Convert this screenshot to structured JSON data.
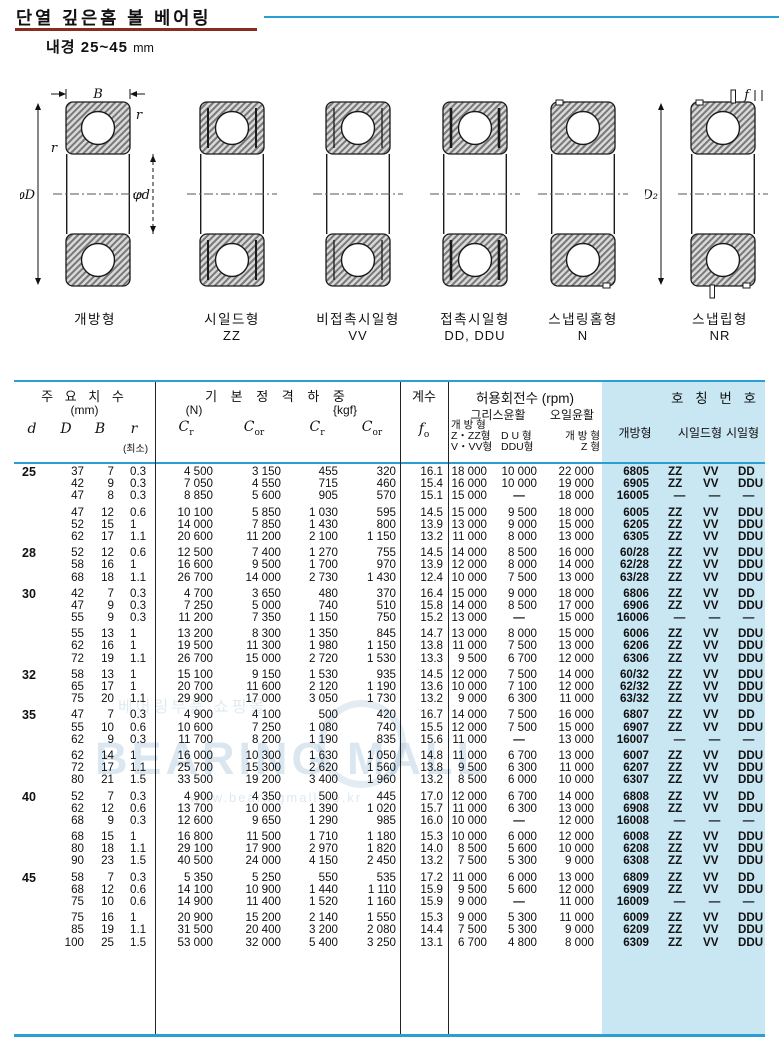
{
  "title": "단열 깊은홈 볼 베어링",
  "subtitle_label": "내경",
  "subtitle_range": "25~45",
  "subtitle_unit": "mm",
  "colors": {
    "accent_blue": "#2a9fd3",
    "light_blue": "#c9e6f3",
    "underline_red": "#8b2a1e"
  },
  "figures": [
    {
      "label": "개방형",
      "sublabel": ""
    },
    {
      "label": "시일드형",
      "sublabel": "ZZ"
    },
    {
      "label": "비접촉시일형",
      "sublabel": "VV"
    },
    {
      "label": "접촉시일형",
      "sublabel": "DD, DDU"
    },
    {
      "label": "스냅링홈형",
      "sublabel": "N"
    },
    {
      "label": "스냅립형",
      "sublabel": "NR"
    }
  ],
  "annotations": {
    "B": "B",
    "r": "r",
    "phiD": "φD",
    "phid": "φd",
    "f": "f",
    "phiD2": "φD₂"
  },
  "watermark": {
    "line1": "베어링부품 쇼핑몰",
    "line2": "BEARING MALL",
    "line3": "www.bearingmall.co.kr"
  },
  "table": {
    "header": {
      "dims_title": "주 요 치 수",
      "dims_unit": "(mm)",
      "col_d": "d",
      "col_D": "D",
      "col_B": "B",
      "col_r": "r",
      "r_min": "(최소)",
      "load_title": "기 본 정 격 하 중",
      "unit_n": "(N)",
      "unit_kgf": "{kgf}",
      "c_base": "C",
      "sub_r": "r",
      "sub_or": "or",
      "factor_title": "계수",
      "f_base": "f",
      "f_sub": "o",
      "rpm_title": "허용회전수 (rpm)",
      "grease_title": "그리스윤활",
      "oil_title": "오일윤활",
      "g1_l1": "개 방 형",
      "g1_l2": "Z・ZZ형",
      "g1_l3": "V・VV형",
      "g2_l2": "D U 형",
      "g2_l3": "DDU형",
      "oil_l2": "개 방 형",
      "oil_l3": "Z 형",
      "no_title": "호 칭 번 호",
      "no_open": "개방형",
      "no_shield": "시일드형",
      "no_seal": "시일형"
    },
    "groups": [
      {
        "d": "25",
        "blocks": [
          [
            [
              "37",
              "7",
              "0.3",
              "4 500",
              "3 150",
              "455",
              "320",
              "16.1",
              "18 000",
              "10 000",
              "22 000",
              "6805",
              "ZZ",
              "VV",
              "DD"
            ],
            [
              "42",
              "9",
              "0.3",
              "7 050",
              "4 550",
              "715",
              "460",
              "15.4",
              "16 000",
              "10 000",
              "19 000",
              "6905",
              "ZZ",
              "VV",
              "DDU"
            ],
            [
              "47",
              "8",
              "0.3",
              "8 850",
              "5 600",
              "905",
              "570",
              "15.1",
              "15 000",
              "—",
              "18 000",
              "16005",
              "—",
              "—",
              "—"
            ]
          ],
          [
            [
              "47",
              "12",
              "0.6",
              "10 100",
              "5 850",
              "1 030",
              "595",
              "14.5",
              "15 000",
              "9 500",
              "18 000",
              "6005",
              "ZZ",
              "VV",
              "DDU"
            ],
            [
              "52",
              "15",
              "1",
              "14 000",
              "7 850",
              "1 430",
              "800",
              "13.9",
              "13 000",
              "9 000",
              "15 000",
              "6205",
              "ZZ",
              "VV",
              "DDU"
            ],
            [
              "62",
              "17",
              "1.1",
              "20 600",
              "11 200",
              "2 100",
              "1 150",
              "13.2",
              "11 000",
              "8 000",
              "13 000",
              "6305",
              "ZZ",
              "VV",
              "DDU"
            ]
          ]
        ]
      },
      {
        "d": "28",
        "blocks": [
          [
            [
              "52",
              "12",
              "0.6",
              "12 500",
              "7 400",
              "1 270",
              "755",
              "14.5",
              "14 000",
              "8 500",
              "16 000",
              "60/28",
              "ZZ",
              "VV",
              "DDU"
            ],
            [
              "58",
              "16",
              "1",
              "16 600",
              "9 500",
              "1 700",
              "970",
              "13.9",
              "12 000",
              "8 000",
              "14 000",
              "62/28",
              "ZZ",
              "VV",
              "DDU"
            ],
            [
              "68",
              "18",
              "1.1",
              "26 700",
              "14 000",
              "2 730",
              "1 430",
              "12.4",
              "10 000",
              "7 500",
              "13 000",
              "63/28",
              "ZZ",
              "VV",
              "DDU"
            ]
          ]
        ]
      },
      {
        "d": "30",
        "blocks": [
          [
            [
              "42",
              "7",
              "0.3",
              "4 700",
              "3 650",
              "480",
              "370",
              "16.4",
              "15 000",
              "9 000",
              "18 000",
              "6806",
              "ZZ",
              "VV",
              "DD"
            ],
            [
              "47",
              "9",
              "0.3",
              "7 250",
              "5 000",
              "740",
              "510",
              "15.8",
              "14 000",
              "8 500",
              "17 000",
              "6906",
              "ZZ",
              "VV",
              "DDU"
            ],
            [
              "55",
              "9",
              "0.3",
              "11 200",
              "7 350",
              "1 150",
              "750",
              "15.2",
              "13 000",
              "—",
              "15 000",
              "16006",
              "—",
              "—",
              "—"
            ]
          ],
          [
            [
              "55",
              "13",
              "1",
              "13 200",
              "8 300",
              "1 350",
              "845",
              "14.7",
              "13 000",
              "8 000",
              "15 000",
              "6006",
              "ZZ",
              "VV",
              "DDU"
            ],
            [
              "62",
              "16",
              "1",
              "19 500",
              "11 300",
              "1 980",
              "1 150",
              "13.8",
              "11 000",
              "7 500",
              "13 000",
              "6206",
              "ZZ",
              "VV",
              "DDU"
            ],
            [
              "72",
              "19",
              "1.1",
              "26 700",
              "15 000",
              "2 720",
              "1 530",
              "13.3",
              "9 500",
              "6 700",
              "12 000",
              "6306",
              "ZZ",
              "VV",
              "DDU"
            ]
          ]
        ]
      },
      {
        "d": "32",
        "blocks": [
          [
            [
              "58",
              "13",
              "1",
              "15 100",
              "9 150",
              "1 530",
              "935",
              "14.5",
              "12 000",
              "7 500",
              "14 000",
              "60/32",
              "ZZ",
              "VV",
              "DDU"
            ],
            [
              "65",
              "17",
              "1",
              "20 700",
              "11 600",
              "2 120",
              "1 190",
              "13.6",
              "10 000",
              "7 100",
              "12 000",
              "62/32",
              "ZZ",
              "VV",
              "DDU"
            ],
            [
              "75",
              "20",
              "1.1",
              "29 900",
              "17 000",
              "3 050",
              "1 730",
              "13.2",
              "9 000",
              "6 300",
              "11 000",
              "63/32",
              "ZZ",
              "VV",
              "DDU"
            ]
          ]
        ]
      },
      {
        "d": "35",
        "blocks": [
          [
            [
              "47",
              "7",
              "0.3",
              "4 900",
              "4 100",
              "500",
              "420",
              "16.7",
              "14 000",
              "7 500",
              "16 000",
              "6807",
              "ZZ",
              "VV",
              "DD"
            ],
            [
              "55",
              "10",
              "0.6",
              "10 600",
              "7 250",
              "1 080",
              "740",
              "15.5",
              "12 000",
              "7 500",
              "15 000",
              "6907",
              "ZZ",
              "VV",
              "DDU"
            ],
            [
              "62",
              "9",
              "0.3",
              "11 700",
              "8 200",
              "1 190",
              "835",
              "15.6",
              "11 000",
              "—",
              "13 000",
              "16007",
              "—",
              "—",
              "—"
            ]
          ],
          [
            [
              "62",
              "14",
              "1",
              "16 000",
              "10 300",
              "1 630",
              "1 050",
              "14.8",
              "11 000",
              "6 700",
              "13 000",
              "6007",
              "ZZ",
              "VV",
              "DDU"
            ],
            [
              "72",
              "17",
              "1.1",
              "25 700",
              "15 300",
              "2 620",
              "1 560",
              "13.8",
              "9 500",
              "6 300",
              "11 000",
              "6207",
              "ZZ",
              "VV",
              "DDU"
            ],
            [
              "80",
              "21",
              "1.5",
              "33 500",
              "19 200",
              "3 400",
              "1 960",
              "13.2",
              "8 500",
              "6 000",
              "10 000",
              "6307",
              "ZZ",
              "VV",
              "DDU"
            ]
          ]
        ]
      },
      {
        "d": "40",
        "blocks": [
          [
            [
              "52",
              "7",
              "0.3",
              "4 900",
              "4 350",
              "500",
              "445",
              "17.0",
              "12 000",
              "6 700",
              "14 000",
              "6808",
              "ZZ",
              "VV",
              "DD"
            ],
            [
              "62",
              "12",
              "0.6",
              "13 700",
              "10 000",
              "1 390",
              "1 020",
              "15.7",
              "11 000",
              "6 300",
              "13 000",
              "6908",
              "ZZ",
              "VV",
              "DDU"
            ],
            [
              "68",
              "9",
              "0.3",
              "12 600",
              "9 650",
              "1 290",
              "985",
              "16.0",
              "10 000",
              "—",
              "12 000",
              "16008",
              "—",
              "—",
              "—"
            ]
          ],
          [
            [
              "68",
              "15",
              "1",
              "16 800",
              "11 500",
              "1 710",
              "1 180",
              "15.3",
              "10 000",
              "6 000",
              "12 000",
              "6008",
              "ZZ",
              "VV",
              "DDU"
            ],
            [
              "80",
              "18",
              "1.1",
              "29 100",
              "17 900",
              "2 970",
              "1 820",
              "14.0",
              "8 500",
              "5 600",
              "10 000",
              "6208",
              "ZZ",
              "VV",
              "DDU"
            ],
            [
              "90",
              "23",
              "1.5",
              "40 500",
              "24 000",
              "4 150",
              "2 450",
              "13.2",
              "7 500",
              "5 300",
              "9 000",
              "6308",
              "ZZ",
              "VV",
              "DDU"
            ]
          ]
        ]
      },
      {
        "d": "45",
        "blocks": [
          [
            [
              "58",
              "7",
              "0.3",
              "5 350",
              "5 250",
              "550",
              "535",
              "17.2",
              "11 000",
              "6 000",
              "13 000",
              "6809",
              "ZZ",
              "VV",
              "DD"
            ],
            [
              "68",
              "12",
              "0.6",
              "14 100",
              "10 900",
              "1 440",
              "1 110",
              "15.9",
              "9 500",
              "5 600",
              "12 000",
              "6909",
              "ZZ",
              "VV",
              "DDU"
            ],
            [
              "75",
              "10",
              "0.6",
              "14 900",
              "11 400",
              "1 520",
              "1 160",
              "15.9",
              "9 000",
              "—",
              "11 000",
              "16009",
              "—",
              "—",
              "—"
            ]
          ],
          [
            [
              "75",
              "16",
              "1",
              "20 900",
              "15 200",
              "2 140",
              "1 550",
              "15.3",
              "9 000",
              "5 300",
              "11 000",
              "6009",
              "ZZ",
              "VV",
              "DDU"
            ],
            [
              "85",
              "19",
              "1.1",
              "31 500",
              "20 400",
              "3 200",
              "2 080",
              "14.4",
              "7 500",
              "5 300",
              "9 000",
              "6209",
              "ZZ",
              "VV",
              "DDU"
            ],
            [
              "100",
              "25",
              "1.5",
              "53 000",
              "32 000",
              "5 400",
              "3 250",
              "13.1",
              "6 700",
              "4 800",
              "8 000",
              "6309",
              "ZZ",
              "VV",
              "DDU"
            ]
          ]
        ]
      }
    ]
  }
}
